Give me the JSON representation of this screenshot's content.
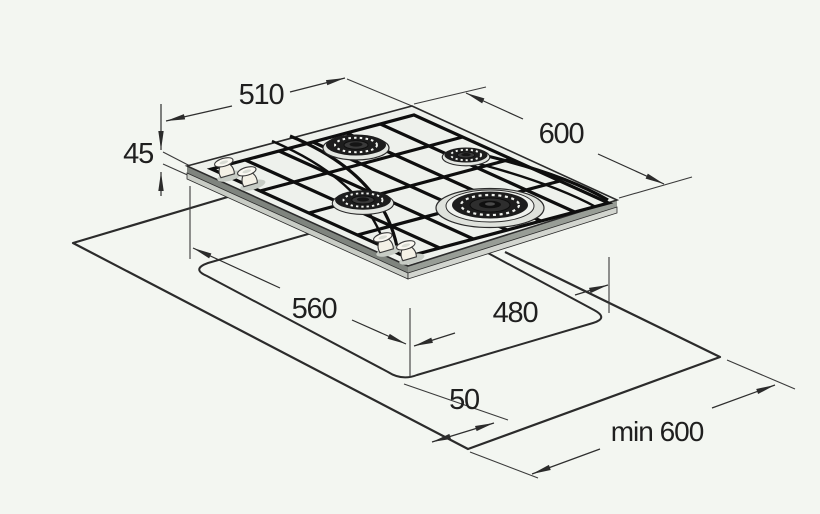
{
  "diagram": {
    "title": "gas-hob-installation-dimensions",
    "dimensions": {
      "hob_width": "510",
      "hob_depth": "600",
      "hob_height": "45",
      "cutout_width": "560",
      "cutout_depth": "480",
      "front_edge_distance": "50",
      "min_worktop_depth": "min 600"
    },
    "colors": {
      "background": "#f3f6f1",
      "line": "#2b2b2b",
      "hob_surface": "#eef1ec",
      "hob_side_dark": "#7f847e",
      "hob_side_light": "#c8ccc5",
      "burner": "#1d1d1d",
      "knob": "#f4f1e6"
    }
  }
}
